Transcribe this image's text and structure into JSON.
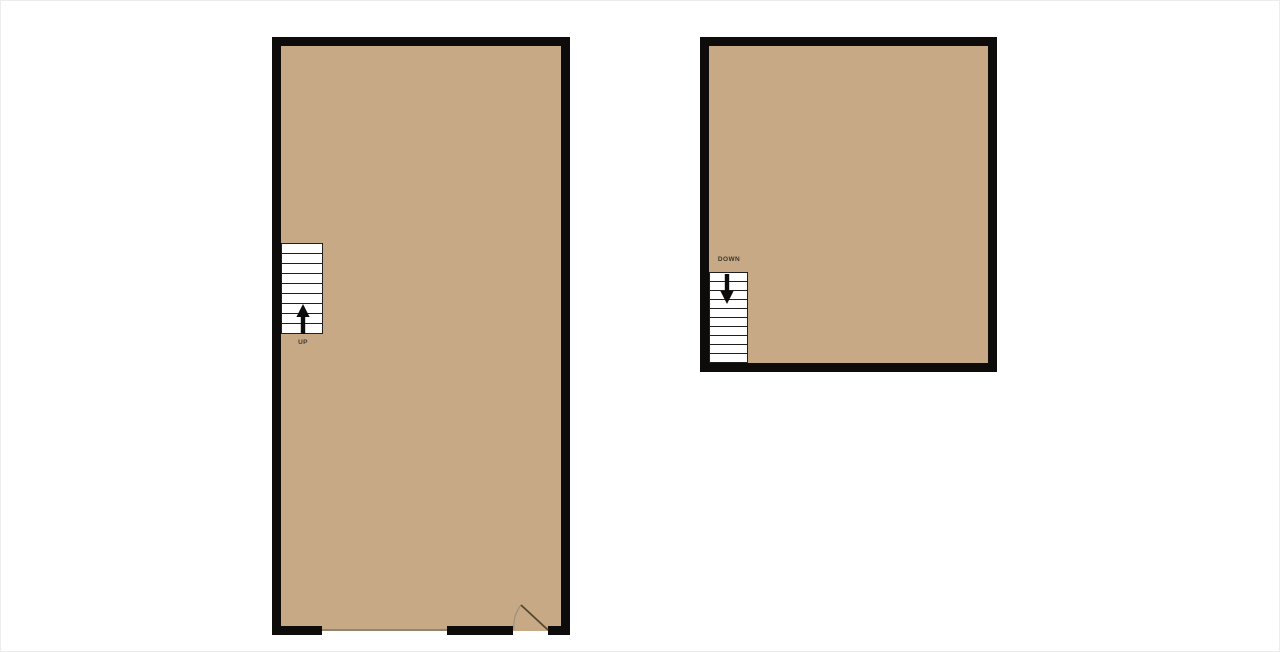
{
  "colors": {
    "floor": "#c7aa85",
    "wall": "#0d0c0a",
    "stair": "#1f1f1f",
    "openline": "#8d8672",
    "door_leaf": "#55472f",
    "door_arc": "#9a9281",
    "arrow": "#0d0c0a",
    "label": "#3b372f"
  },
  "floorplan": {
    "rooms": [
      {
        "id": "left-room",
        "shape": "tall-rectangle",
        "features": [
          "stairs-up",
          "wide-wall-opening",
          "door-bottom-right"
        ]
      },
      {
        "id": "right-room",
        "shape": "square",
        "features": [
          "stairs-down"
        ]
      }
    ],
    "stairs": [
      {
        "label": "UP",
        "direction": "up",
        "treads": 9
      },
      {
        "label": "DOWN",
        "direction": "down",
        "treads": 10
      }
    ],
    "door": {
      "type": "swing-door",
      "location": "left-room-bottom-right"
    },
    "opening": {
      "type": "wide-opening",
      "location": "left-room-bottom"
    }
  }
}
